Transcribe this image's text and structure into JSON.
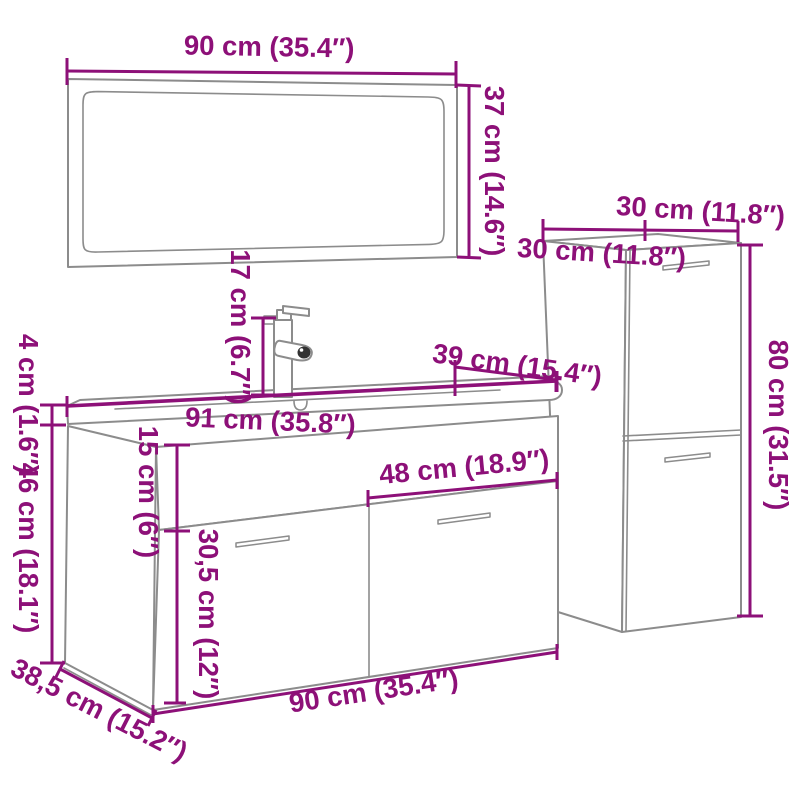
{
  "canvas": {
    "width": 800,
    "height": 800,
    "background": "#FFFFFF"
  },
  "colors": {
    "dimension_accent": "#8D1078",
    "furniture_outline": "#8C8C8C",
    "spout_opening": "#333333"
  },
  "diagram": {
    "type": "furniture-dimension-diagram",
    "parts": [
      "mirror",
      "faucet",
      "vanity-basin-cabinet",
      "tall-side-cabinet"
    ]
  },
  "dimensions": {
    "mirror_width": "90 cm (35.4″)",
    "mirror_height": "37 cm (14.6″)",
    "faucet_height": "17 cm (6.7″)",
    "side_cabinet_width": "30 cm (11.8″)",
    "side_cabinet_depth": "30 cm (11.8″)",
    "side_cabinet_height": "80 cm (31.5″)",
    "basin_depth": "39 cm (15.4″)",
    "basin_width": "91 cm (35.8″)",
    "basin_top_thickness": "4 cm (1.6″)",
    "vanity_body_height": "46 cm (18.1″)",
    "basin_front_height": "15 cm (6″)",
    "door_width": "48 cm (18.9″)",
    "door_height": "30,5 cm (12″)",
    "vanity_width": "90 cm (35.4″)",
    "vanity_depth": "38,5 cm (15.2″)"
  }
}
